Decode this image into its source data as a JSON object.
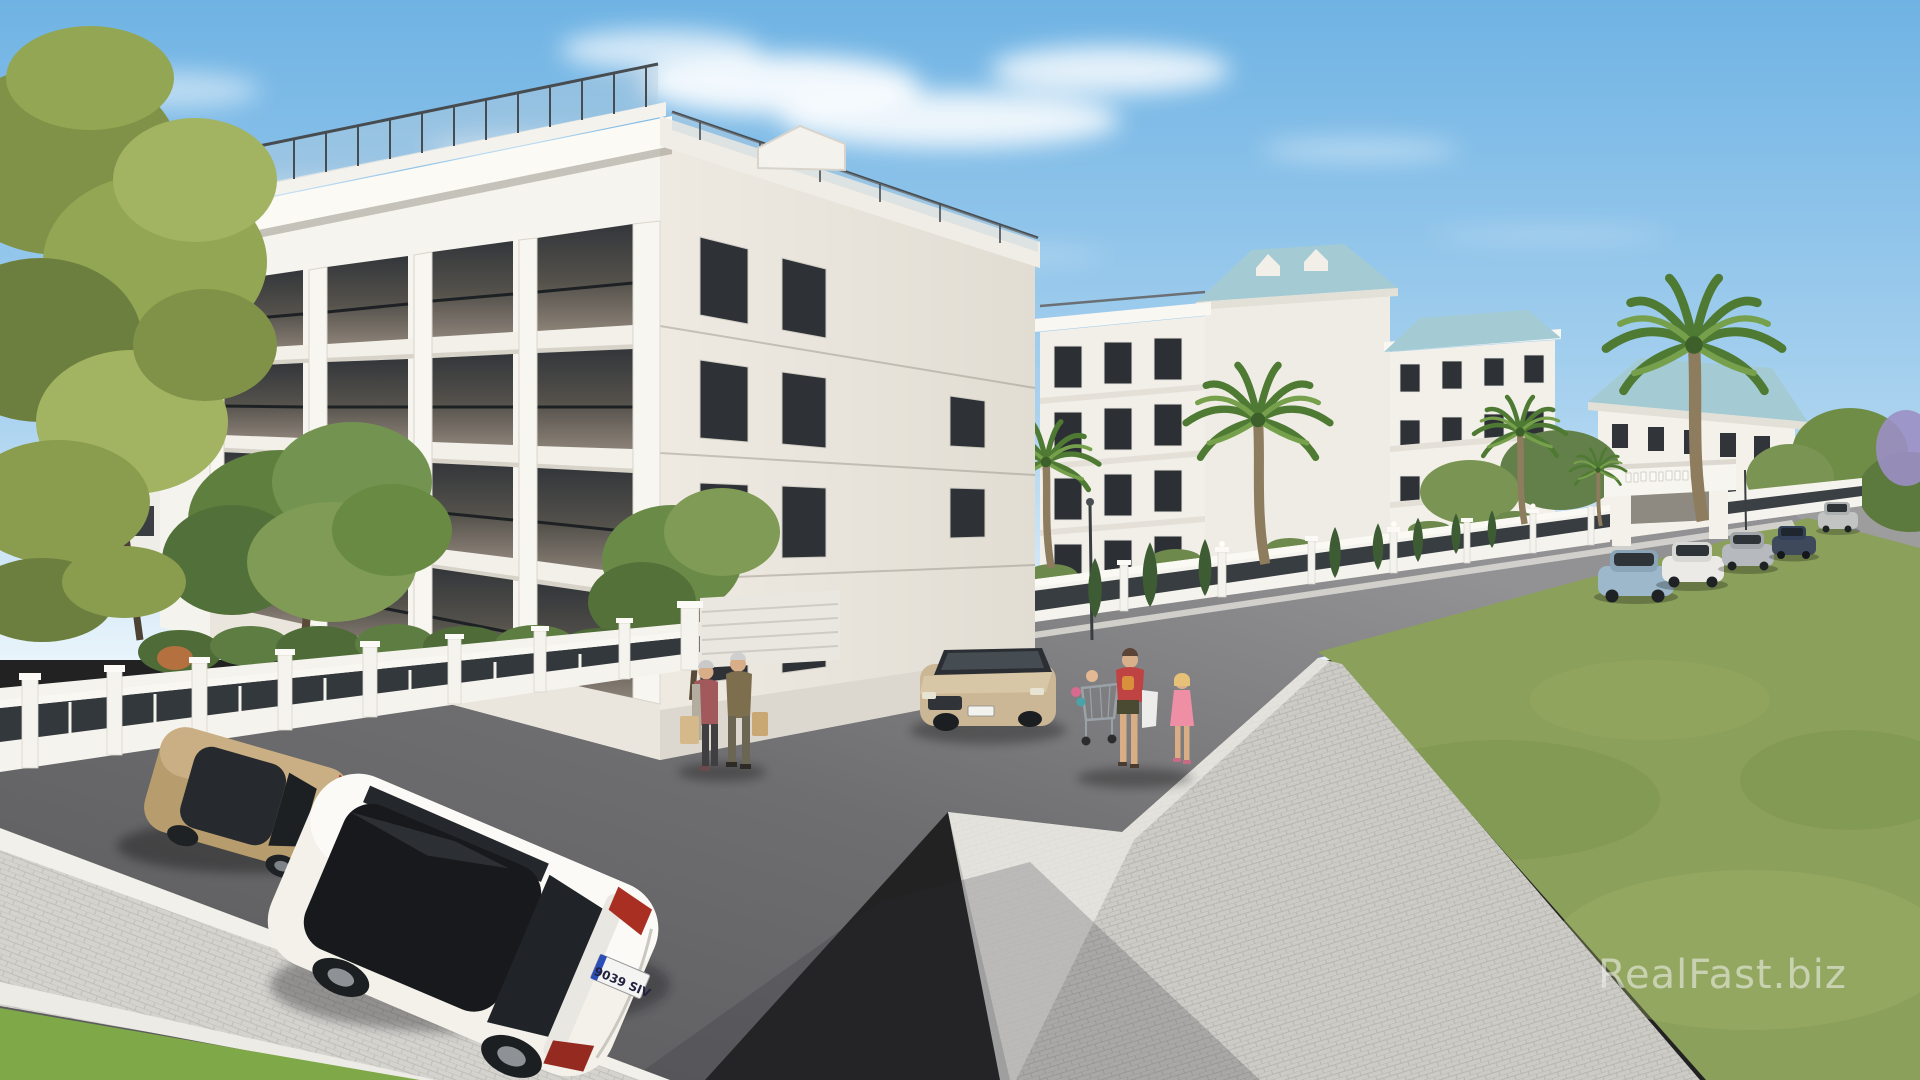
{
  "watermark": {
    "text": "RealFast.biz"
  },
  "vehicles": {
    "white_hatchback": {
      "plate": "9039 SIV",
      "color": "#f3f1ea"
    },
    "gold_sedan": {
      "color": "#b79c6d"
    },
    "parked_beige_hatchback": {
      "color": "#cbb795"
    },
    "parked_row": [
      "#9db8ca",
      "#eceae7",
      "#b6b9bd",
      "#3e4a5c",
      "#c2c4c4"
    ]
  },
  "scene": {
    "people_count": 5,
    "building_floors": 4
  },
  "palette": {
    "sky_top": "#6fb3e4",
    "sky_mid": "#a9d2ef",
    "sky_horizon": "#e9f4fb",
    "facade": "#f6f4ee",
    "facade_shade": "#e8e4dc",
    "window_dark": "#2b2f33",
    "roof_teal": "#a4cbd3",
    "fence_white": "#f5f3ed",
    "railing_dark": "#33383c",
    "asphalt": "#59595b",
    "asphalt_far": "#929294",
    "paver": "#cfcec9",
    "curb": "#f1f0ea",
    "lawn": "#8ba05b",
    "grass_bright": "#7fa848",
    "foliage": "#6f8d47",
    "palm_green": "#4e7a33",
    "trunk": "#8d7c5e"
  }
}
